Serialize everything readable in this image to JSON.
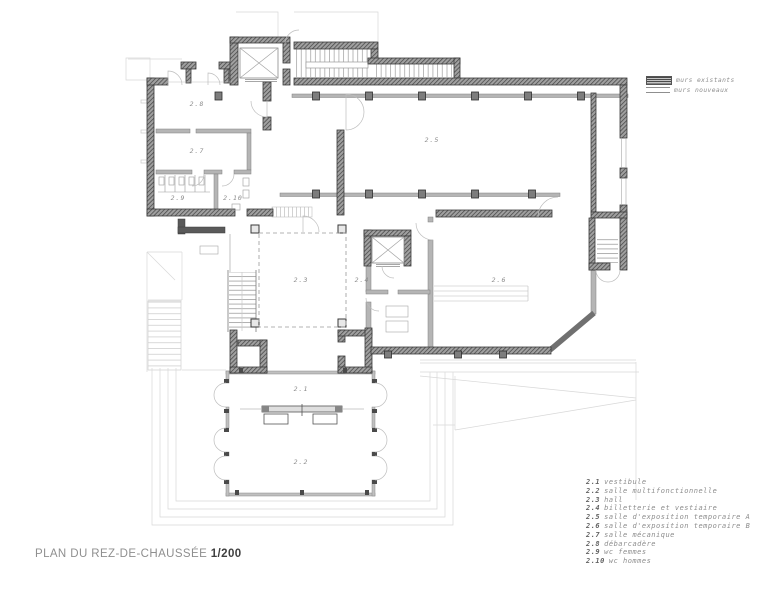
{
  "title": {
    "text": "PLAN DU REZ-DE-CHAUSSÉE",
    "scale": "1/200"
  },
  "wall_legend": {
    "existing": "murs existants",
    "new": "murs nouveaux"
  },
  "rooms": [
    {
      "number": "2.1",
      "name": "vestibule"
    },
    {
      "number": "2.2",
      "name": "salle multifonctionnelle"
    },
    {
      "number": "2.3",
      "name": "hall"
    },
    {
      "number": "2.4",
      "name": "billetterie et vestiaire"
    },
    {
      "number": "2.5",
      "name": "salle d'exposition temporaire A"
    },
    {
      "number": "2.6",
      "name": "salle d'exposition temporaire B"
    },
    {
      "number": "2.7",
      "name": "salle mécanique"
    },
    {
      "number": "2.8",
      "name": "débarcadère"
    },
    {
      "number": "2.9",
      "name": "wc femmes"
    },
    {
      "number": "2.10",
      "name": "wc hommes"
    }
  ],
  "plan_labels": [
    {
      "label": "2.8"
    },
    {
      "label": "2.7"
    },
    {
      "label": "2.9"
    },
    {
      "label": "2.10"
    },
    {
      "label": "2.5"
    },
    {
      "label": "2.3"
    },
    {
      "label": "2.4"
    },
    {
      "label": "2.6"
    },
    {
      "label": "2.1"
    },
    {
      "label": "2.2"
    }
  ],
  "colors": {
    "existing_wall": "#3d3d3d",
    "new_wall": "#b5b5b5",
    "faint_line": "#d6d6d6",
    "label_text": "#8a8a8a",
    "title_text": "#8f8f8f",
    "scale_text": "#3f3f3f"
  }
}
